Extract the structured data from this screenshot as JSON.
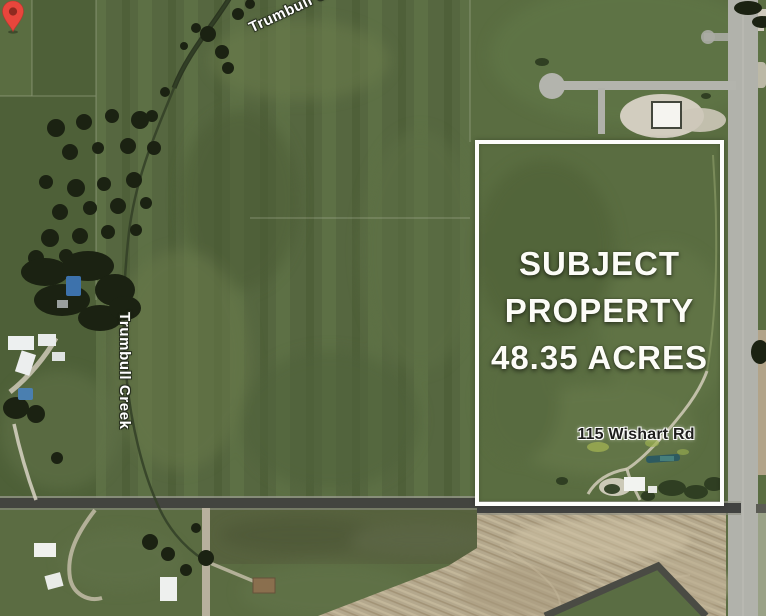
{
  "map": {
    "view": "aerial-satellite",
    "overlay": {
      "property_label_lines": [
        "SUBJECT",
        "PROPERTY",
        "48.35 ACRES"
      ],
      "acres": "48.35",
      "boundary_color": "#fdfdfb"
    },
    "marker": {
      "address": "115 Wishart Rd",
      "pin_color": "#e8463c",
      "pin_dot_color": "#8f2a20"
    },
    "labels": {
      "creek_top": "Trumbull Creek",
      "creek_left": "Trumbull Creek"
    },
    "palette": {
      "field_green_base": "#55673d",
      "field_green_dark": "#4e6038",
      "field_green_bright": "#62794a",
      "plowed_tan": "#b4a88d",
      "road_gray": "#b3b4ad",
      "road_asphalt": "#424340",
      "tree_dark": "#1b2212",
      "creek_label_white": "#ffffff",
      "address_text": "#1e1e1c",
      "title_white": "#fcfcf7"
    }
  }
}
